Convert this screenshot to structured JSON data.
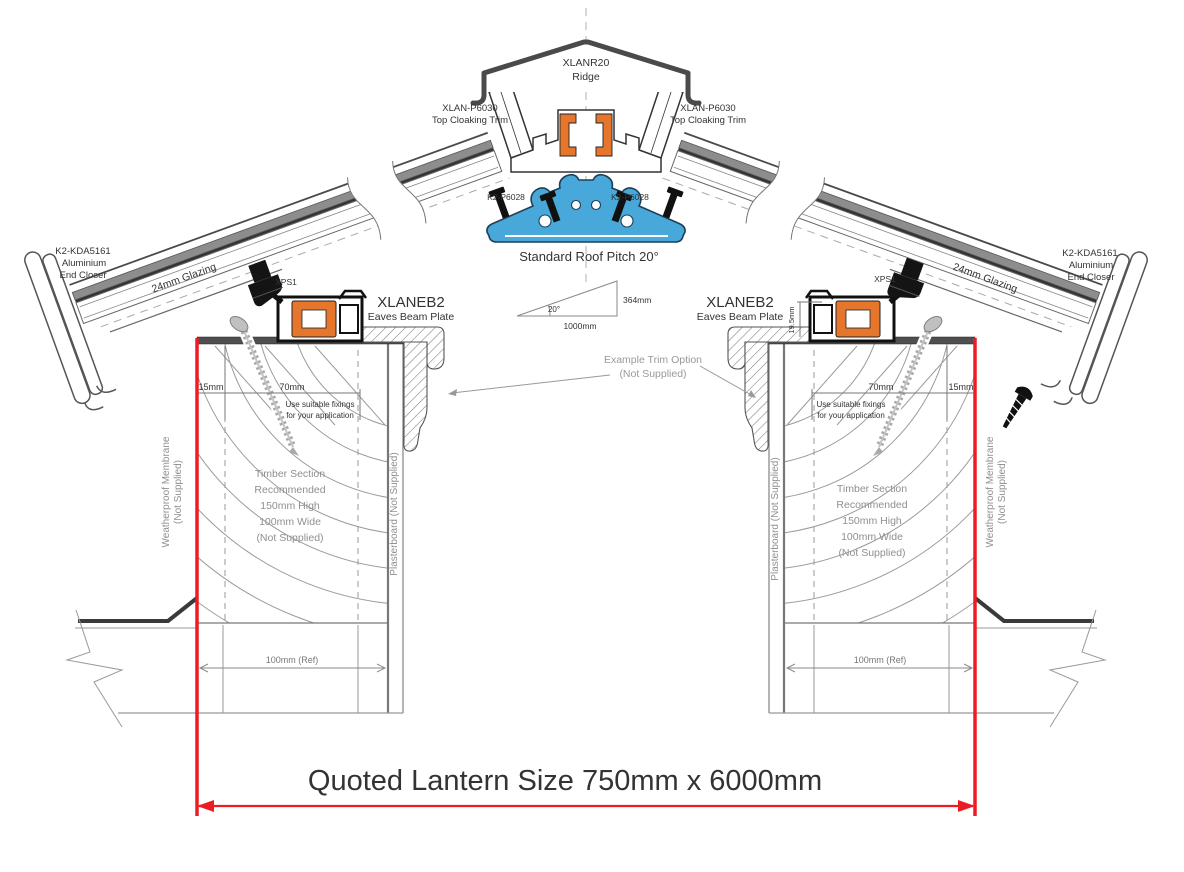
{
  "labels": {
    "ridge_part": "XLANR20",
    "ridge_name": "Ridge",
    "cloaking_part": "XLAN-P6030",
    "cloaking_name": "Top Cloaking Trim",
    "ridge_clamp": "K2-P6028",
    "pitch_title": "Standard Roof Pitch 20°",
    "pitch_angle": "20°",
    "pitch_run": "1000mm",
    "pitch_rise": "364mm",
    "eaves_part": "XLANEB2",
    "eaves_name": "Eaves Beam Plate",
    "spacer": "XPS1",
    "end_closer_part": "K2-KDA5161",
    "end_closer_material": "Aluminium",
    "end_closer_name": "End Closer",
    "glazing": "24mm Glazing",
    "plate_height_dim": "19.5mm",
    "trim_option_line1": "Example Trim Option",
    "trim_option_line2": "(Not Supplied)",
    "dim_edge": "15mm",
    "dim_plate": "70mm",
    "dim_ref": "100mm (Ref)",
    "fixings_line1": "Use suitable fixings",
    "fixings_line2": "for your application",
    "timber_line1": "Timber Section",
    "timber_line2": "Recommended",
    "timber_line3": "150mm High",
    "timber_line4": "100mm Wide",
    "timber_line5": "(Not Supplied)",
    "membrane_line1": "Weatherproof Membrane",
    "membrane_line2": "(Not Supplied)",
    "plasterboard": "Plasterboard (Not Supplied)",
    "quoted_size": "Quoted Lantern Size 750mm x 6000mm"
  },
  "colors": {
    "accent_red": "#ed1c24",
    "profile_blue": "#47a8d9",
    "thermal_orange": "#e5762c",
    "steel_dark": "#4a4a4a"
  }
}
